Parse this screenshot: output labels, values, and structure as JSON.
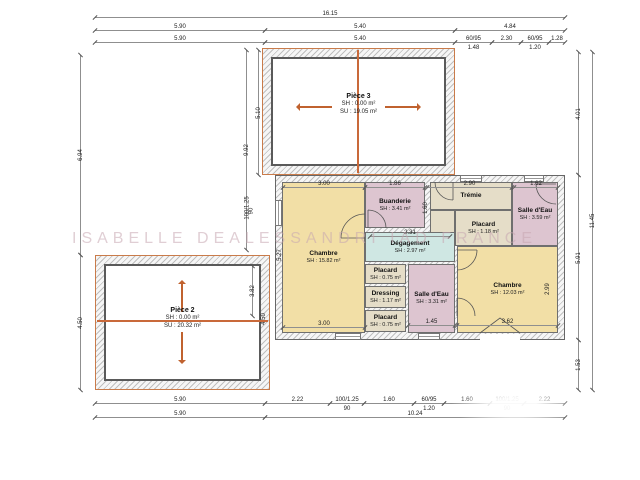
{
  "watermark": {
    "text": "ISABELLE DEALESSANDRI IAD FRANCE"
  },
  "colors": {
    "accent_orange": "#c0622f",
    "room_yellow": "#f2dfa6",
    "room_pink": "#ddc5d0",
    "room_beige": "#e5ddc8",
    "room_cyan": "#cfe7e3",
    "wall_hatch": "#bfbfbf",
    "watermark_pink": "#c6a6b0"
  },
  "dims": {
    "top_total": "16.15",
    "top2": [
      "5.90",
      "5.40",
      "4.84"
    ],
    "top3": [
      "5.90",
      "5.40",
      "60/95",
      "2.30",
      "60/95",
      "1.28"
    ],
    "top3_subs": [
      "1.48",
      "1.20"
    ],
    "bottom1": [
      "5.90",
      "2.22",
      "100/1.25",
      "1.60",
      "60/95",
      "1.60",
      "100/1.25",
      "2.22"
    ],
    "bottom1_subs": [
      "90",
      "1.20",
      "90"
    ],
    "bottom2": [
      "5.90",
      "10.24"
    ],
    "left": [
      "6.94",
      "4.50"
    ],
    "right_inner": [
      "4.01",
      "5.91",
      "1.53"
    ],
    "right_outer": "11.45",
    "aux_left": [
      "5.10",
      "9.92",
      "100/1.25",
      "90"
    ],
    "inner_top": [
      "3.00",
      "1.86",
      "2.90",
      "1.62"
    ],
    "inner_bottom": [
      "3.00",
      "1.45",
      "3.62"
    ],
    "inner_misc": {
      "chambre_left_h": "5.27",
      "buanderie_tremie": "1.60",
      "chambre_right_h": "2.99",
      "piece2_h": "3.82",
      "piece2_wall": "4.50",
      "degagement_w": "2.31"
    }
  },
  "rooms": {
    "piece3": {
      "name": "Pièce 3",
      "sh": "SH : 0.00 m²",
      "su": "SU : 19.05 m²"
    },
    "piece2": {
      "name": "Pièce 2",
      "sh": "SH : 0.00 m²",
      "su": "SU : 20.32 m²"
    },
    "chambre_left": {
      "name": "Chambre",
      "sh": "SH : 15.82 m²"
    },
    "buanderie": {
      "name": "Buanderie",
      "sh": "SH : 3.41 m²"
    },
    "tremie": {
      "name": "Trémie"
    },
    "placard_tremie": {
      "name": "Placard",
      "sh": "SH : 1.18 m²"
    },
    "salle_eau_top": {
      "name": "Salle d'Eau",
      "sh": "SH : 3.59 m²"
    },
    "degagement": {
      "name": "Dégagement",
      "sh": "SH : 2.97 m²"
    },
    "placard_top": {
      "name": "Placard",
      "sh": "SH : 0.75 m²"
    },
    "dressing": {
      "name": "Dressing",
      "sh": "SH : 1.17 m²"
    },
    "placard_bottom": {
      "name": "Placard",
      "sh": "SH : 0.75 m²"
    },
    "salle_eau_bottom": {
      "name": "Salle d'Eau",
      "sh": "SH : 3.31 m²"
    },
    "chambre_right": {
      "name": "Chambre",
      "sh": "SH : 12.03 m²"
    }
  }
}
